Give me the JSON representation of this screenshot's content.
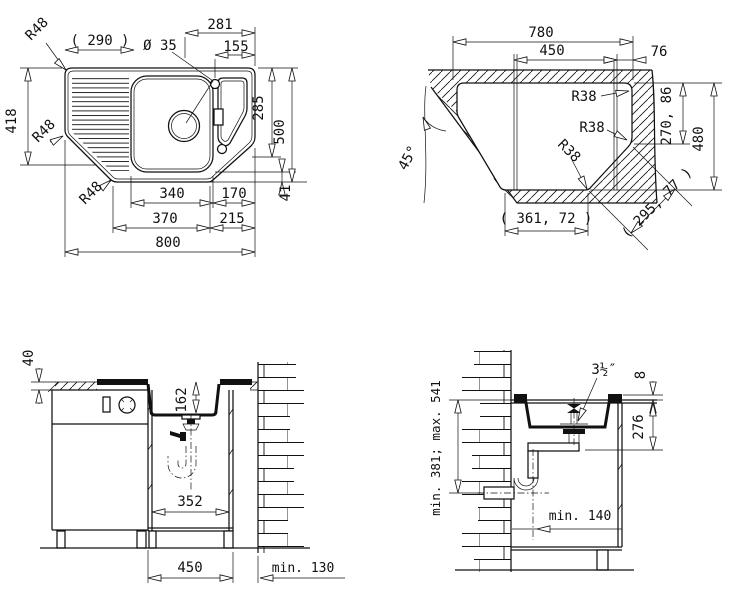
{
  "drawing": {
    "views": {
      "plan": {
        "dims": {
          "r48_a": "R48",
          "r48_b": "R48",
          "r48_c": "R48",
          "d290": "( 290 )",
          "d281": "281",
          "dia": "Ø 35",
          "d155": "155",
          "d418": "418",
          "d285": "285",
          "d500": "500",
          "d41": "41",
          "d340": "340",
          "d170": "170",
          "d370": "370",
          "d215": "215",
          "d800": "800"
        }
      },
      "cutout": {
        "dims": {
          "d780": "780",
          "d450": "450",
          "d76": "76",
          "r38_a": "R38",
          "r38_b": "R38",
          "r38_c": "R38",
          "angle": "45°",
          "d270": "270, 86",
          "d480": "480",
          "d361": "( 361, 72 )",
          "d295": "( 295, 77 )"
        }
      },
      "front_section": {
        "dims": {
          "d40": "40",
          "d162": "162",
          "d352": "352",
          "d450": "450",
          "d130": "min. 130"
        }
      },
      "side_section": {
        "dims": {
          "drain": "3½″",
          "d8": "8",
          "d276": "276",
          "d541": "min. 381; max. 541",
          "d140": "min. 140"
        }
      }
    }
  }
}
